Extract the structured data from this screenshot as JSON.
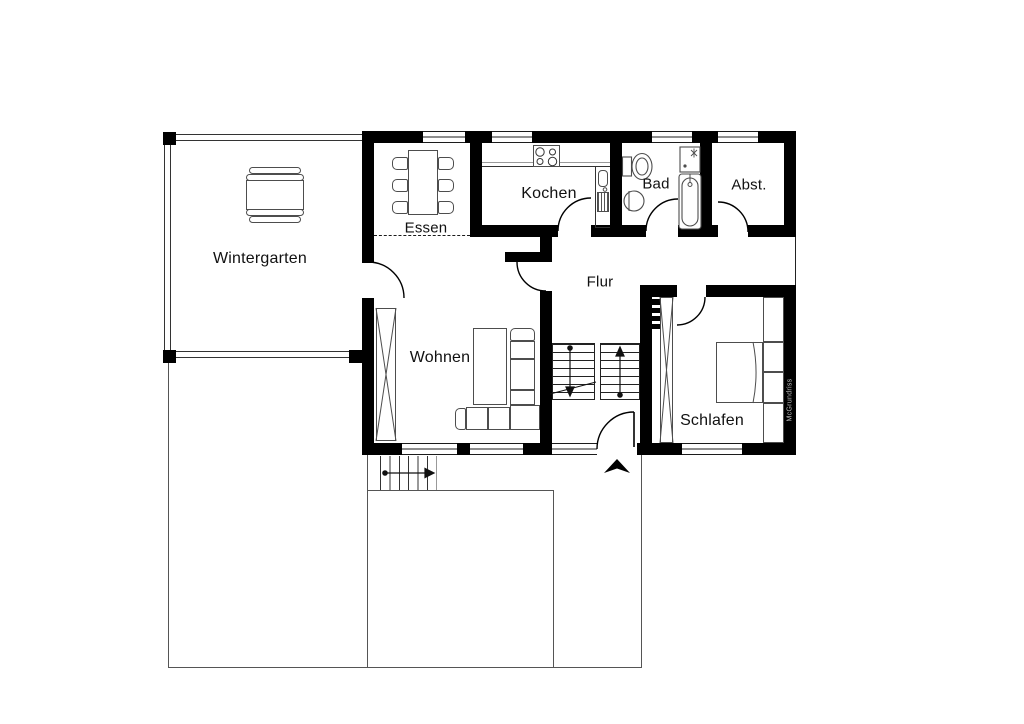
{
  "plan": {
    "type": "apartment-floor-plan",
    "colors": {
      "wall": "#000000",
      "background": "#ffffff",
      "furniture_line": "#4d4d4d"
    }
  },
  "rooms": {
    "wintergarten": {
      "label": "Wintergarten"
    },
    "essen": {
      "label": "Essen"
    },
    "kochen": {
      "label": "Kochen"
    },
    "bad": {
      "label": "Bad"
    },
    "abstellraum": {
      "label": "Abst."
    },
    "flur": {
      "label": "Flur"
    },
    "wohnen": {
      "label": "Wohnen"
    },
    "schlafen": {
      "label": "Schlafen"
    }
  },
  "watermark": {
    "label": "McGrundriss"
  },
  "icons": [
    "stairs-down-arrow-icon",
    "stairs-up-arrow-icon",
    "entrance-arrow-icon",
    "stove-icon",
    "sink-icon",
    "toilet-icon",
    "bathtub-icon",
    "shower-icon",
    "bed-icon",
    "sofa-icon",
    "dining-table-icon",
    "radiator-icon",
    "wardrobe-icon"
  ]
}
